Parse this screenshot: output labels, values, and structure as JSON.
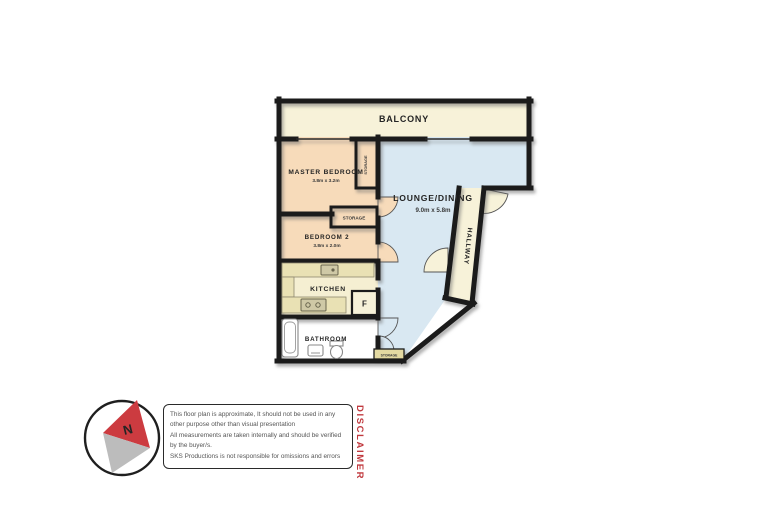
{
  "colors": {
    "wall": "#1b1b1b",
    "balcony": "#f7f2d9",
    "bedroom": "#f7dbba",
    "lounge": "#d9e8f2",
    "kitchen": "#f5efd2",
    "hallway": "#f7f2d9",
    "storage": "#e3d9a2",
    "counter": "#e9e1b4",
    "bathroom": "#ffffff",
    "fridge_box": "#f6f1d8",
    "accent_red": "#cc3b40",
    "needle_gray": "#bcbcbc"
  },
  "rooms": {
    "balcony": {
      "label": "BALCONY"
    },
    "master_bedroom": {
      "label": "MASTER BEDROOM",
      "dims": "3.8m x 3.2m"
    },
    "bedroom2": {
      "label": "BEDROOM 2",
      "dims": "3.8m x 2.0m"
    },
    "lounge_dining": {
      "label": "LOUNGE/DINING",
      "dims": "9.0m x 5.8m"
    },
    "kitchen": {
      "label": "KITCHEN"
    },
    "bathroom": {
      "label": "BATHROOM"
    },
    "hallway": {
      "label": "HALLWAY"
    },
    "storage_upper": {
      "label": "STORAGE"
    },
    "storage_middle": {
      "label": "STORAGE"
    },
    "storage_lower": {
      "label": "STORAGE"
    },
    "fridge": {
      "label": "F"
    }
  },
  "compass": {
    "north_label": "N"
  },
  "disclaimer": {
    "title": "DISCLAIMER",
    "lines": [
      "This floor plan is approximate, It should not be used in any",
      "other purpose other than visual presentation",
      "All measurements are taken internally and should be verified",
      "by the buyer/s.",
      "SKS Productions is not responsible for omissions and errors"
    ]
  }
}
